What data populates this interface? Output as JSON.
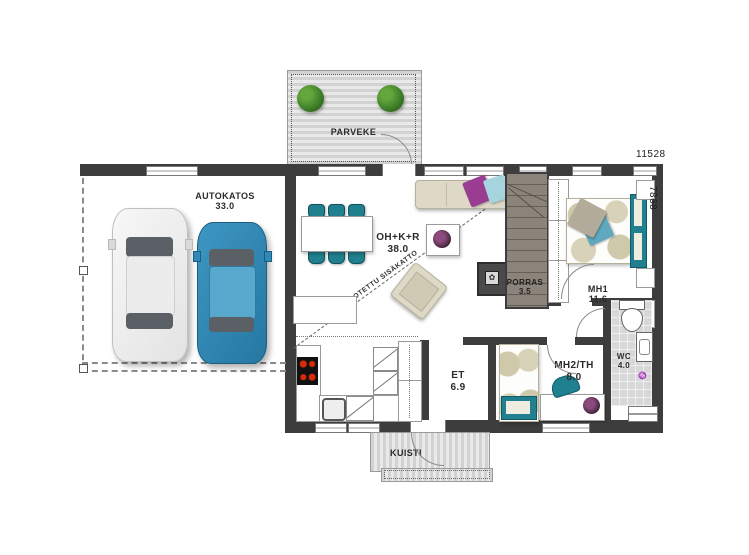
{
  "plan": {
    "title": "one-storey house floor plan",
    "dimensions": {
      "width_label": "11528",
      "height_label": "7868"
    },
    "rooms": {
      "parveke": {
        "name": "PARVEKE"
      },
      "autokatos": {
        "name": "AUTOKATOS",
        "area": "33.0"
      },
      "oh_k_r": {
        "name": "OH+K+R",
        "area": "38.0"
      },
      "porras": {
        "name": "PORRAS",
        "area": "3.5"
      },
      "mh1": {
        "name": "MH1",
        "area": "11.6"
      },
      "wc": {
        "name": "WC",
        "area": "4.0"
      },
      "mh2": {
        "name": "MH2/TH",
        "area": "8.0"
      },
      "et": {
        "name": "ET",
        "area": "6.9"
      },
      "kuisti": {
        "name": "KUISTI"
      }
    },
    "annotations": {
      "ceiling_note": "KOROTETTU SISÄKATTO"
    },
    "colors": {
      "wall": "#3d3d3d",
      "deck": "#d6d6d6",
      "teal_furniture": "#20808f",
      "beige_furniture": "#ded9c6",
      "blue_car": "#2f8ab8",
      "white_car": "#f4f4f4",
      "purple_pillow": "#993c92",
      "light_blue_pillow": "#a6d4de",
      "burner_red": "#c41e00",
      "plant_green": "#3c7d26",
      "stairs_fill": "#857f76",
      "wc_floor": "#d8d8d8"
    },
    "icon_legend": {
      "plants": "round shrub markers on balcony",
      "cars": "two parked cars in carport",
      "cooktop": "4-burner stove",
      "toilet": "wc toilet",
      "sink": "washbasin",
      "floor_drain": "drain mark"
    }
  }
}
